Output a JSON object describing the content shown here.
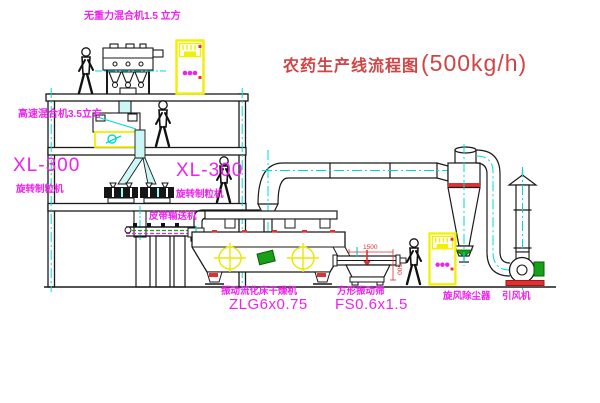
{
  "title": {
    "name": "农药生产线流程图",
    "capacity": "(500kg/h)"
  },
  "labels": {
    "top_mixer": "无重力混合机1.5 立方",
    "high_speed_mixer": "高速混合机3.5立方",
    "xl300_left": "XL-300",
    "granulator_left": "旋转制粒机",
    "xl300_right": "XL-300",
    "granulator_right": "旋转制粒机",
    "belt_conveyor": "皮带输送机",
    "dryer_name": "振动流化床干燥机",
    "dryer_model": "ZLG6x0.75",
    "sieve_name": "方形振动筛",
    "sieve_model": "FS0.6x1.5",
    "cyclone": "旋风除尘器",
    "fan": "引风机"
  },
  "dimensions": {
    "sieve_length": "1500",
    "sieve_height": "500"
  },
  "colors": {
    "label_magenta": "#ee22ee",
    "title_red": "#cf4444",
    "accent_red": "#e03030",
    "centerline_cyan": "#00d8d8",
    "cabinet_yellow": "#f0f000",
    "machine_green": "#18a018"
  }
}
